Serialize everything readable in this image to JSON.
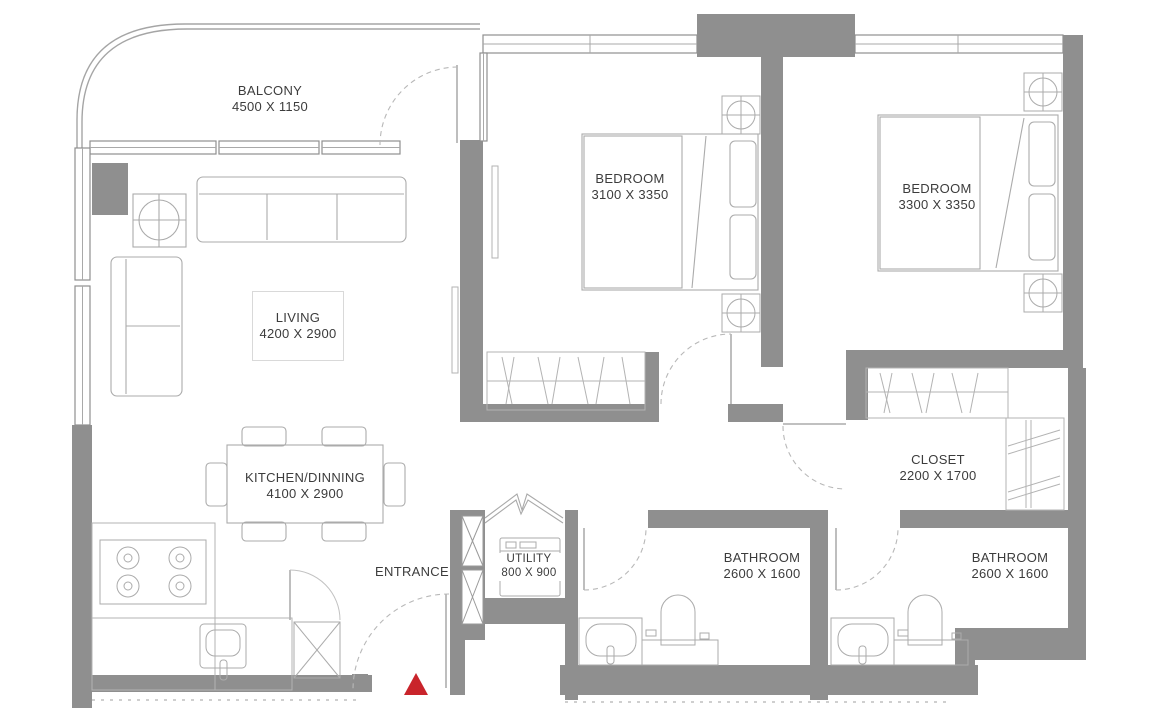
{
  "plan": {
    "background_color": "#ffffff",
    "wall_color": "#8f8f8f",
    "line_color": "#ababab",
    "text_color": "#3c3c3c",
    "rooms": [
      {
        "id": "balcony",
        "name": "BALCONY",
        "dims": "4500 X 1150"
      },
      {
        "id": "living",
        "name": "LIVING",
        "dims": "4200 X 2900"
      },
      {
        "id": "kitchen-dining",
        "name": "KITCHEN/DINNING",
        "dims": "4100 X 2900"
      },
      {
        "id": "bedroom-1",
        "name": "BEDROOM",
        "dims": "3100 X 3350"
      },
      {
        "id": "bedroom-2",
        "name": "BEDROOM",
        "dims": "3300 X 3350"
      },
      {
        "id": "closet",
        "name": "CLOSET",
        "dims": "2200 X 1700"
      },
      {
        "id": "bathroom-1",
        "name": "BATHROOM",
        "dims": "2600 X 1600"
      },
      {
        "id": "bathroom-2",
        "name": "BATHROOM",
        "dims": "2600 X 1600"
      },
      {
        "id": "utility",
        "name": "UTILITY",
        "dims": "800 X 900"
      }
    ],
    "entrance_label": "ENTRANCE",
    "entrance_marker_color": "#c9242b"
  }
}
